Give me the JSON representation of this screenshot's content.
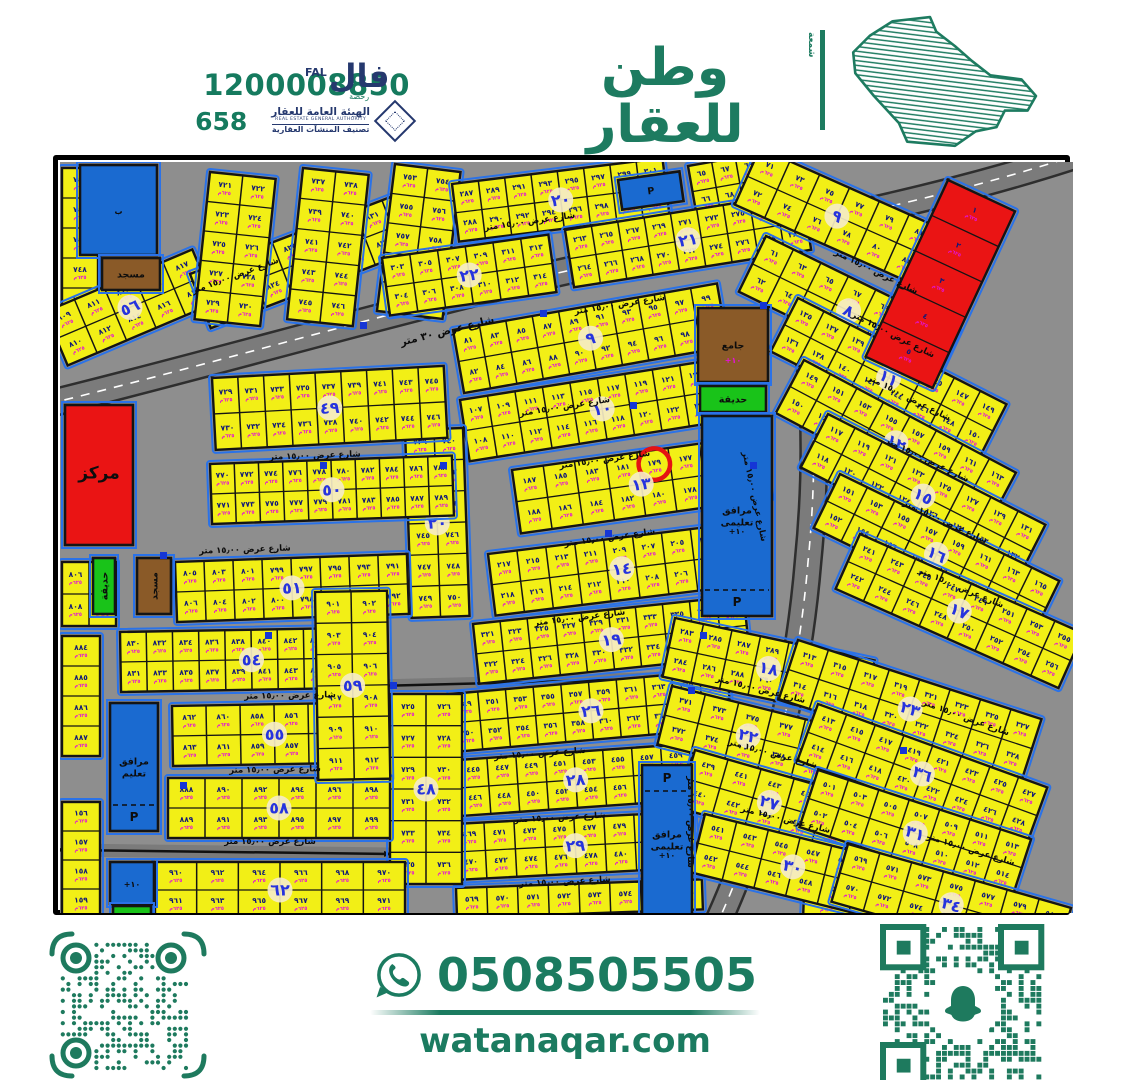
{
  "header": {
    "reg_number": "1200008850",
    "classification_number": "658",
    "fal": {
      "ar": "فال",
      "en": "FAL",
      "sub": "رخصة"
    },
    "authority": {
      "ar": "الهيئة العامة للعقار",
      "en": "REAL ESTATE GENERAL AUTHORITY",
      "sub": "تصنيف المنشآت العقارية"
    },
    "brand": {
      "ar": "وطن للعقار",
      "en": "WATAN REAL ESTATE",
      "side": "شمعة"
    }
  },
  "footer": {
    "phone": "0508505505",
    "website": "watanaqar.com"
  },
  "map": {
    "size": [
      1013,
      751
    ],
    "colors": {
      "bg": "#8e8e8e",
      "road": "#7b7b7b",
      "road_edge": "#2e2e2e",
      "plot": "#f2ef16",
      "plot_line": "#141414",
      "curb": "#2a72e8",
      "plot_num": "#101878",
      "plot_sub": "#e313d6",
      "badge_bg": "#f5ecc7",
      "badge_num": "#2633de",
      "red": "#ea1414",
      "blue": "#1a6ad0",
      "green": "#19c319",
      "brown": "#8a5a28",
      "highlight": "#e51212"
    },
    "street_label": "شارع عرض ١٥٫٠٠ متر",
    "main_street_label": "شارع عرض ٣٠ متر",
    "plot_area_label": "٦٢٥م",
    "main_label_pos": {
      "x": 388,
      "y": 172,
      "r": -14
    },
    "roads": {
      "arteryA": "M -12 242 C 200 190, 430 120, 610 88 C 730 67, 880 38, 1020 -8",
      "arteryD": "M 702 30 C 752 120, 762 260, 748 400 C 738 520, 708 650, 658 760",
      "collectorC": [
        318,
        524,
        700,
        514
      ],
      "collectorB": [
        5,
        688,
        332,
        692
      ]
    },
    "blocks": [
      {
        "n": "",
        "x": 2,
        "y": 6,
        "w": 36,
        "h": 150,
        "rot": 0,
        "cols": 1,
        "rows": 5,
        "start": 745
      },
      {
        "n": "٥٦",
        "x": -15,
        "y": 150,
        "w": 160,
        "h": 58,
        "rot": -23,
        "cols": 5,
        "rows": 2,
        "start": 809,
        "pat": "asc"
      },
      {
        "n": "٥٧",
        "x": 130,
        "y": 112,
        "w": 235,
        "h": 58,
        "rot": -21,
        "cols": 8,
        "rows": 2,
        "start": 819,
        "pat": "asc"
      },
      {
        "n": "",
        "x": 150,
        "y": 10,
        "w": 66,
        "h": 148,
        "rot": 6,
        "cols": 2,
        "rows": 5,
        "start": 721
      },
      {
        "n": "",
        "x": 243,
        "y": 6,
        "w": 66,
        "h": 152,
        "rot": 6,
        "cols": 2,
        "rows": 5,
        "start": 737
      },
      {
        "n": "",
        "x": 335,
        "y": 2,
        "w": 66,
        "h": 148,
        "rot": 7,
        "cols": 2,
        "rows": 5,
        "start": 753
      },
      {
        "n": "٢٠",
        "x": 392,
        "y": 22,
        "w": 212,
        "h": 58,
        "rot": -7,
        "cols": 8,
        "rows": 2,
        "start": 287,
        "pat": "asc"
      },
      {
        "n": "",
        "x": 628,
        "y": 4,
        "w": 72,
        "h": 52,
        "rot": -10,
        "cols": 3,
        "rows": 2,
        "start": 65,
        "pat": "asc"
      },
      {
        "n": "٢١",
        "x": 505,
        "y": 68,
        "w": 240,
        "h": 58,
        "rot": -9,
        "cols": 9,
        "rows": 2,
        "start": 263,
        "pat": "asc"
      },
      {
        "n": "٢٢",
        "x": 322,
        "y": 96,
        "w": 168,
        "h": 58,
        "rot": -8,
        "cols": 6,
        "rows": 2,
        "start": 303,
        "pat": "asc"
      },
      {
        "n": "٩",
        "x": 393,
        "y": 168,
        "w": 268,
        "h": 64,
        "rot": -10,
        "cols": 10,
        "rows": 2,
        "start": 81,
        "pat": "asc"
      },
      {
        "n": "١٠",
        "x": 400,
        "y": 238,
        "w": 278,
        "h": 62,
        "rot": -9,
        "cols": 10,
        "rows": 2,
        "start": 107,
        "pat": "asc"
      },
      {
        "n": "١٣",
        "x": 452,
        "y": 308,
        "w": 252,
        "h": 64,
        "rot": -8,
        "cols": 8,
        "rows": 2,
        "start": 173,
        "pat": "desc",
        "hl": [
          0,
          4
        ]
      },
      {
        "n": "١٤",
        "x": 428,
        "y": 392,
        "w": 262,
        "h": 62,
        "rot": -7,
        "cols": 9,
        "rows": 2,
        "start": 201,
        "pat": "desc"
      },
      {
        "n": "١٩",
        "x": 413,
        "y": 462,
        "w": 272,
        "h": 60,
        "rot": -6,
        "cols": 10,
        "rows": 2,
        "start": 321,
        "pat": "asc"
      },
      {
        "n": "٢٦",
        "x": 390,
        "y": 532,
        "w": 278,
        "h": 58,
        "rot": -5,
        "cols": 10,
        "rows": 2,
        "start": 349,
        "pat": "asc"
      },
      {
        "n": "٢٨",
        "x": 398,
        "y": 598,
        "w": 232,
        "h": 56,
        "rot": -4,
        "cols": 8,
        "rows": 2,
        "start": 445,
        "pat": "asc"
      },
      {
        "n": "٢٩",
        "x": 394,
        "y": 662,
        "w": 240,
        "h": 56,
        "rot": -3,
        "cols": 8,
        "rows": 2,
        "start": 469,
        "pat": "asc"
      },
      {
        "n": "",
        "x": 396,
        "y": 726,
        "w": 246,
        "h": 30,
        "rot": -2,
        "cols": 8,
        "rows": 1,
        "start": 569
      },
      {
        "n": "٤٨",
        "x": 330,
        "y": 532,
        "w": 72,
        "h": 190,
        "rot": 0,
        "cols": 2,
        "rows": 6,
        "start": 725
      },
      {
        "n": "٢٠",
        "x": 345,
        "y": 268,
        "w": 58,
        "h": 188,
        "rot": -2,
        "cols": 2,
        "rows": 6,
        "start": 739
      },
      {
        "n": "٤٩",
        "x": 152,
        "y": 216,
        "w": 232,
        "h": 72,
        "rot": -3,
        "cols": 9,
        "rows": 2,
        "start": 729,
        "pat": "asc"
      },
      {
        "n": "٥٠",
        "x": 150,
        "y": 302,
        "w": 242,
        "h": 60,
        "rot": -2,
        "cols": 10,
        "rows": 2,
        "start": 770,
        "pat": "asc"
      },
      {
        "n": "٥١",
        "x": 115,
        "y": 400,
        "w": 232,
        "h": 60,
        "rot": -2,
        "cols": 8,
        "rows": 2,
        "start": 791,
        "pat": "desc"
      },
      {
        "n": "٥٤",
        "x": 60,
        "y": 470,
        "w": 262,
        "h": 60,
        "rot": -1,
        "cols": 10,
        "rows": 2,
        "start": 830,
        "pat": "asc"
      },
      {
        "n": "٥٥",
        "x": 112,
        "y": 544,
        "w": 204,
        "h": 60,
        "rot": -1,
        "cols": 6,
        "rows": 2,
        "start": 852,
        "pat": "desc"
      },
      {
        "n": "٥٨",
        "x": 108,
        "y": 616,
        "w": 222,
        "h": 60,
        "rot": 0,
        "cols": 6,
        "rows": 2,
        "start": 888,
        "pat": "asc"
      },
      {
        "n": "٥٩",
        "x": 255,
        "y": 430,
        "w": 72,
        "h": 188,
        "rot": -1,
        "cols": 2,
        "rows": 6,
        "start": 901
      },
      {
        "n": "٦٢",
        "x": 95,
        "y": 700,
        "w": 250,
        "h": 56,
        "rot": 0,
        "cols": 6,
        "rows": 2,
        "start": 960,
        "pat": "asc"
      },
      {
        "n": "",
        "x": 745,
        "y": 702,
        "w": 92,
        "h": 54,
        "rot": 2,
        "cols": 2,
        "rows": 2,
        "start": 144
      },
      {
        "n": "",
        "x": 2,
        "y": 400,
        "w": 54,
        "h": 64,
        "rot": 0,
        "cols": 2,
        "rows": 2,
        "start": 806
      },
      {
        "n": "",
        "x": 2,
        "y": 474,
        "w": 38,
        "h": 120,
        "rot": 0,
        "cols": 1,
        "rows": 4,
        "start": 884
      },
      {
        "n": "",
        "x": 2,
        "y": 640,
        "w": 38,
        "h": 116,
        "rot": 0,
        "cols": 1,
        "rows": 4,
        "start": 156
      },
      {
        "n": "٩",
        "x": 700,
        "y": -14,
        "w": 196,
        "h": 62,
        "rot": 24,
        "cols": 6,
        "rows": 2,
        "start": 71,
        "pat": "asc"
      },
      {
        "n": "٨",
        "x": 706,
        "y": 74,
        "w": 214,
        "h": 62,
        "rot": 26,
        "cols": 7,
        "rows": 2,
        "start": 61,
        "pat": "asc"
      },
      {
        "n": "١١",
        "x": 738,
        "y": 136,
        "w": 234,
        "h": 60,
        "rot": 27,
        "cols": 8,
        "rows": 2,
        "start": 135,
        "pat": "asc"
      },
      {
        "n": "١٢",
        "x": 744,
        "y": 198,
        "w": 240,
        "h": 60,
        "rot": 28,
        "cols": 8,
        "rows": 2,
        "start": 149,
        "pat": "asc"
      },
      {
        "n": "١٥",
        "x": 768,
        "y": 252,
        "w": 244,
        "h": 60,
        "rot": 27,
        "cols": 8,
        "rows": 2,
        "start": 117,
        "pat": "asc"
      },
      {
        "n": "١٦",
        "x": 780,
        "y": 312,
        "w": 244,
        "h": 60,
        "rot": 26,
        "cols": 8,
        "rows": 2,
        "start": 151,
        "pat": "asc"
      },
      {
        "n": "١٧",
        "x": 800,
        "y": 372,
        "w": 244,
        "h": 60,
        "rot": 24,
        "cols": 8,
        "rows": 2,
        "start": 241,
        "pat": "asc"
      },
      {
        "n": "١٨",
        "x": 615,
        "y": 456,
        "w": 204,
        "h": 60,
        "rot": 12,
        "cols": 7,
        "rows": 2,
        "start": 283,
        "pat": "asc"
      },
      {
        "n": "٢٣",
        "x": 738,
        "y": 478,
        "w": 256,
        "h": 62,
        "rot": 18,
        "cols": 8,
        "rows": 2,
        "start": 313,
        "pat": "asc"
      },
      {
        "n": "٢٢",
        "x": 612,
        "y": 524,
        "w": 172,
        "h": 60,
        "rot": 14,
        "cols": 5,
        "rows": 2,
        "start": 371,
        "pat": "asc"
      },
      {
        "n": "٣٦",
        "x": 758,
        "y": 542,
        "w": 244,
        "h": 60,
        "rot": 20,
        "cols": 8,
        "rows": 2,
        "start": 413,
        "pat": "asc"
      },
      {
        "n": "٢٧",
        "x": 635,
        "y": 588,
        "w": 172,
        "h": 60,
        "rot": 16,
        "cols": 5,
        "rows": 2,
        "start": 439,
        "pat": "asc"
      },
      {
        "n": "٣١",
        "x": 758,
        "y": 608,
        "w": 224,
        "h": 60,
        "rot": 18,
        "cols": 7,
        "rows": 2,
        "start": 501,
        "pat": "asc"
      },
      {
        "n": "٣٠",
        "x": 645,
        "y": 652,
        "w": 196,
        "h": 60,
        "rot": 14,
        "cols": 6,
        "rows": 2,
        "start": 541,
        "pat": "asc"
      },
      {
        "n": "٣٤",
        "x": 788,
        "y": 682,
        "w": 232,
        "h": 60,
        "rot": 16,
        "cols": 7,
        "rows": 2,
        "start": 569,
        "pat": "asc"
      },
      {
        "n": "",
        "x": 888,
        "y": 18,
        "w": 74,
        "h": 195,
        "rot": 25,
        "cols": 1,
        "rows": 5,
        "start": 1,
        "fill": "#ea1414"
      }
    ],
    "specials": [
      {
        "x": 20,
        "y": 3,
        "w": 77,
        "h": 90,
        "f": "blue",
        "lbl": "",
        "sub": "ب"
      },
      {
        "x": 42,
        "y": 96,
        "w": 58,
        "h": 32,
        "f": "brown",
        "lbl": "مسجد"
      },
      {
        "x": 5,
        "y": 243,
        "w": 68,
        "h": 140,
        "f": "red",
        "lbl": "مركز",
        "big": true
      },
      {
        "x": 33,
        "y": 396,
        "w": 22,
        "h": 56,
        "f": "green",
        "lbl": "حديقة",
        "rot90": true
      },
      {
        "x": 77,
        "y": 396,
        "w": 34,
        "h": 56,
        "f": "brown",
        "lbl": "مسجد",
        "rot90": true
      },
      {
        "x": 638,
        "y": 146,
        "w": 70,
        "h": 74,
        "f": "brown",
        "lbl": "جامع",
        "sub": "+١٠"
      },
      {
        "x": 640,
        "y": 224,
        "w": 66,
        "h": 26,
        "f": "green",
        "lbl": "حديقة"
      },
      {
        "x": 642,
        "y": 254,
        "w": 70,
        "h": 200,
        "f": "blue",
        "lbl": "مرافق تعليمى",
        "sub": "+١٠",
        "p": "bottom"
      },
      {
        "x": 558,
        "y": 18,
        "w": 62,
        "h": 30,
        "f": "blue",
        "lbl": "P",
        "rot": -8
      },
      {
        "x": 582,
        "y": 603,
        "w": 50,
        "h": 150,
        "f": "blue",
        "lbl": "مرافق تعليمى",
        "sub": "+١٠",
        "p": "top"
      },
      {
        "x": 50,
        "y": 541,
        "w": 48,
        "h": 128,
        "f": "blue",
        "lbl": "مرافق تعليم",
        "p": "bottom"
      },
      {
        "x": 50,
        "y": 700,
        "w": 44,
        "h": 42,
        "f": "blue",
        "lbl": "",
        "sub": "+١٠"
      },
      {
        "x": 53,
        "y": 744,
        "w": 38,
        "h": 12,
        "f": "green",
        "lbl": ""
      }
    ],
    "street_labels": [
      {
        "x": 176,
        "y": 116,
        "r": -20
      },
      {
        "x": 470,
        "y": 62,
        "r": -8
      },
      {
        "x": 560,
        "y": 145,
        "r": -9
      },
      {
        "x": 505,
        "y": 247,
        "r": -9
      },
      {
        "x": 545,
        "y": 300,
        "r": -8
      },
      {
        "x": 550,
        "y": 378,
        "r": -8
      },
      {
        "x": 520,
        "y": 458,
        "r": -7
      },
      {
        "x": 480,
        "y": 594,
        "r": -4
      },
      {
        "x": 500,
        "y": 658,
        "r": -3
      },
      {
        "x": 505,
        "y": 722,
        "r": -3
      },
      {
        "x": 255,
        "y": 296,
        "r": -2
      },
      {
        "x": 185,
        "y": 390,
        "r": -2
      },
      {
        "x": 230,
        "y": 536,
        "r": -1
      },
      {
        "x": 215,
        "y": 610,
        "r": -1
      },
      {
        "x": 210,
        "y": 682,
        "r": 0
      },
      {
        "x": 815,
        "y": 112,
        "r": 26
      },
      {
        "x": 832,
        "y": 175,
        "r": 27
      },
      {
        "x": 848,
        "y": 238,
        "r": 27
      },
      {
        "x": 866,
        "y": 300,
        "r": 26
      },
      {
        "x": 884,
        "y": 362,
        "r": 25
      },
      {
        "x": 900,
        "y": 428,
        "r": 23
      },
      {
        "x": 700,
        "y": 530,
        "r": 14
      },
      {
        "x": 712,
        "y": 594,
        "r": 15
      },
      {
        "x": 725,
        "y": 660,
        "r": 14
      },
      {
        "x": 905,
        "y": 558,
        "r": 20
      },
      {
        "x": 910,
        "y": 690,
        "r": 17
      },
      {
        "x": 628,
        "y": 660,
        "r": 90
      },
      {
        "x": 692,
        "y": 335,
        "r": 78
      }
    ],
    "dots": [
      [
        300,
        160
      ],
      [
        480,
        148
      ],
      [
        570,
        240
      ],
      [
        640,
        470
      ],
      [
        628,
        525
      ],
      [
        380,
        300
      ],
      [
        100,
        390
      ],
      [
        120,
        620
      ],
      [
        330,
        520
      ],
      [
        690,
        300
      ],
      [
        840,
        585
      ],
      [
        545,
        368
      ],
      [
        700,
        140
      ],
      [
        260,
        300
      ],
      [
        205,
        470
      ]
    ],
    "highlighted_plot": "١٧٩"
  }
}
